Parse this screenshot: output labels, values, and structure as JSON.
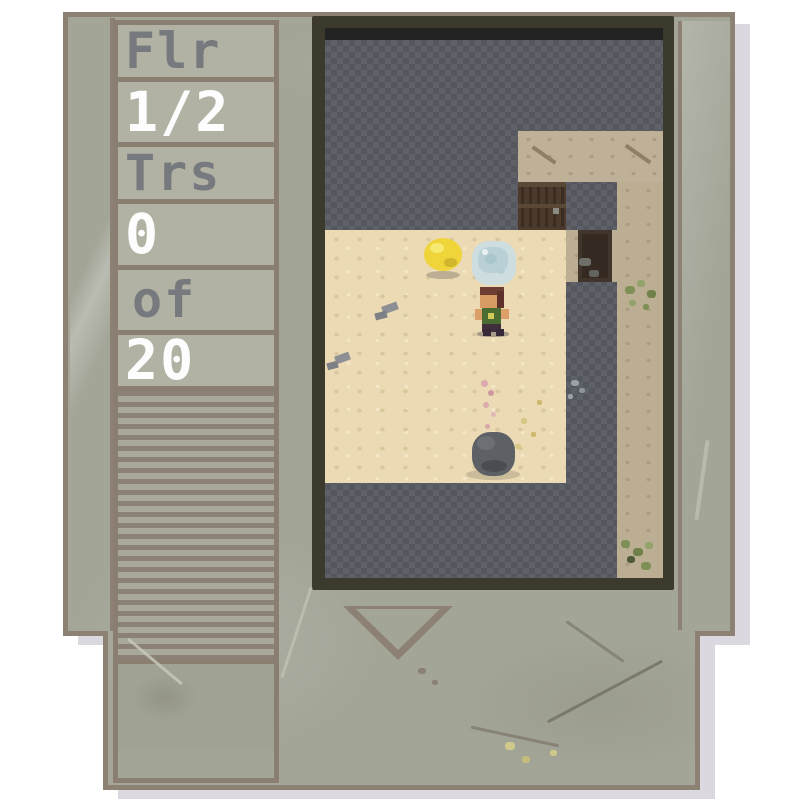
{
  "hud": {
    "cells": [
      {
        "id": "floor-label",
        "label": "Flr",
        "variant": "dim",
        "height": 57
      },
      {
        "id": "floor-value",
        "label": "1/2",
        "variant": "bright",
        "height": 65
      },
      {
        "id": "treasure-label",
        "label": "Trs",
        "variant": "dim",
        "height": 57
      },
      {
        "id": "treasure-count",
        "label": "0",
        "variant": "bright",
        "height": 66
      },
      {
        "id": "treasure-of",
        "label": "of",
        "variant": "dim",
        "height": 65,
        "pad": 14
      },
      {
        "id": "treasure-total",
        "label": "20",
        "variant": "bright",
        "height": 56
      }
    ],
    "text_dim_color": "#76797d",
    "text_bright_color": "#fdfdfd"
  },
  "cartridge": {
    "body_color": "#a3a597",
    "border_color": "#8c8173",
    "cell_color": "#b1b2a3",
    "grip_line_color": "#8b8177",
    "shadow_color": "#dbd9df",
    "window_frame_color": "#3c3a2c"
  },
  "viewport": {
    "wall_color": "#575b61",
    "sand_color": "#ebdab4",
    "rock_floor_color": "#bfb197",
    "layers": [
      {
        "name": "void-strip",
        "rects": [
          {
            "x": 0,
            "y": 0,
            "w": 338,
            "h": 12,
            "c": "#232323"
          }
        ]
      },
      {
        "name": "rock-floor-regions",
        "rects": [
          {
            "x": 193,
            "y": 103,
            "w": 145,
            "h": 51,
            "c": "#bfb197",
            "cls": "tex-tan"
          },
          {
            "x": 292,
            "y": 154,
            "w": 46,
            "h": 396,
            "c": "#bcae93",
            "cls": "tex-tan"
          },
          {
            "x": 241,
            "y": 202,
            "w": 51,
            "h": 52,
            "c": "#bcae93",
            "cls": "tex-tan"
          }
        ]
      },
      {
        "name": "sand-floor-region",
        "rects": [
          {
            "x": 0,
            "y": 202,
            "w": 241,
            "h": 253,
            "c": "#ebdab4",
            "cls": "tex-sand"
          }
        ]
      },
      {
        "name": "door-sprite",
        "rects": [
          {
            "x": 193,
            "y": 154,
            "w": 48,
            "h": 48,
            "c": "#4c3b2d"
          },
          {
            "x": 196,
            "y": 157,
            "w": 3,
            "h": 42,
            "c": "#3b2d22"
          },
          {
            "x": 204,
            "y": 157,
            "w": 3,
            "h": 42,
            "c": "#3b2d22"
          },
          {
            "x": 212,
            "y": 157,
            "w": 3,
            "h": 42,
            "c": "#3b2d22"
          },
          {
            "x": 220,
            "y": 157,
            "w": 3,
            "h": 42,
            "c": "#3b2d22"
          },
          {
            "x": 228,
            "y": 157,
            "w": 3,
            "h": 42,
            "c": "#3b2d22"
          },
          {
            "x": 236,
            "y": 157,
            "w": 3,
            "h": 42,
            "c": "#3b2d22"
          },
          {
            "x": 193,
            "y": 154,
            "w": 48,
            "h": 5,
            "c": "#5a4736"
          },
          {
            "x": 193,
            "y": 176,
            "w": 48,
            "h": 4,
            "c": "#5a4736"
          },
          {
            "x": 228,
            "y": 180,
            "w": 6,
            "h": 6,
            "c": "#8b8b81"
          }
        ]
      },
      {
        "name": "dark-shaft",
        "rects": [
          {
            "x": 253,
            "y": 202,
            "w": 34,
            "h": 52,
            "c": "#41342a"
          },
          {
            "x": 257,
            "y": 206,
            "w": 26,
            "h": 44,
            "c": "#352a22"
          },
          {
            "x": 254,
            "y": 230,
            "w": 12,
            "h": 8,
            "c": "#6f6f69",
            "r": 30
          },
          {
            "x": 264,
            "y": 242,
            "w": 10,
            "h": 7,
            "c": "#63635e",
            "r": 30
          }
        ]
      },
      {
        "name": "floor-marks",
        "rects": [
          {
            "x": 205,
            "y": 125,
            "w": 28,
            "h": 4,
            "c": "#8f7f66",
            "rot": 35
          },
          {
            "x": 298,
            "y": 124,
            "w": 30,
            "h": 4,
            "c": "#8f7f66",
            "rot": 35
          },
          {
            "x": 57,
            "y": 276,
            "w": 16,
            "h": 8,
            "c": "#8d8f94",
            "rot": -20
          },
          {
            "x": 50,
            "y": 284,
            "w": 12,
            "h": 7,
            "c": "#7d8085",
            "rot": -15
          },
          {
            "x": 10,
            "y": 326,
            "w": 15,
            "h": 8,
            "c": "#8d8f94",
            "rot": -20
          },
          {
            "x": 2,
            "y": 334,
            "w": 11,
            "h": 7,
            "c": "#7d8085",
            "rot": -15
          },
          {
            "x": 156,
            "y": 352,
            "w": 7,
            "h": 7,
            "c": "#dba9ae",
            "r": 50
          },
          {
            "x": 163,
            "y": 362,
            "w": 6,
            "h": 6,
            "c": "#cf98a0",
            "r": 50
          },
          {
            "x": 158,
            "y": 374,
            "w": 6,
            "h": 6,
            "c": "#dba9ae",
            "r": 50
          },
          {
            "x": 166,
            "y": 384,
            "w": 5,
            "h": 5,
            "c": "#e0b6ba",
            "r": 50
          },
          {
            "x": 160,
            "y": 396,
            "w": 5,
            "h": 5,
            "c": "#d8a8ac",
            "r": 50
          },
          {
            "x": 196,
            "y": 390,
            "w": 6,
            "h": 6,
            "c": "#d9c784",
            "r": 40
          },
          {
            "x": 206,
            "y": 404,
            "w": 5,
            "h": 5,
            "c": "#cdb86f",
            "r": 40
          },
          {
            "x": 190,
            "y": 416,
            "w": 6,
            "h": 5,
            "c": "#d9c784",
            "r": 40
          },
          {
            "x": 212,
            "y": 372,
            "w": 5,
            "h": 5,
            "c": "#cdb86f",
            "r": 40
          },
          {
            "x": 300,
            "y": 258,
            "w": 10,
            "h": 8,
            "c": "#7e9055",
            "r": 40
          },
          {
            "x": 312,
            "y": 252,
            "w": 8,
            "h": 7,
            "c": "#93a36b",
            "r": 40
          },
          {
            "x": 322,
            "y": 262,
            "w": 9,
            "h": 8,
            "c": "#6f8049",
            "r": 40
          },
          {
            "x": 304,
            "y": 272,
            "w": 7,
            "h": 6,
            "c": "#93a36b",
            "r": 40
          },
          {
            "x": 318,
            "y": 276,
            "w": 6,
            "h": 6,
            "c": "#7e9055",
            "r": 40
          },
          {
            "x": 296,
            "y": 512,
            "w": 9,
            "h": 8,
            "c": "#7e9055",
            "r": 40
          },
          {
            "x": 308,
            "y": 520,
            "w": 10,
            "h": 8,
            "c": "#6f8049",
            "r": 40
          },
          {
            "x": 320,
            "y": 514,
            "w": 8,
            "h": 7,
            "c": "#93a36b",
            "r": 40
          },
          {
            "x": 302,
            "y": 528,
            "w": 8,
            "h": 7,
            "c": "#4e5a3a",
            "r": 40
          },
          {
            "x": 316,
            "y": 534,
            "w": 10,
            "h": 8,
            "c": "#7e9055",
            "r": 40
          },
          {
            "x": 246,
            "y": 352,
            "w": 8,
            "h": 6,
            "c": "#9aa1a8",
            "r": 40
          },
          {
            "x": 254,
            "y": 360,
            "w": 6,
            "h": 5,
            "c": "#8d949b",
            "r": 40
          },
          {
            "x": 243,
            "y": 366,
            "w": 5,
            "h": 5,
            "c": "#9aa1a8",
            "r": 40
          }
        ]
      },
      {
        "name": "coin-sprite",
        "rects": [
          {
            "x": 101,
            "y": 243,
            "w": 34,
            "h": 8,
            "c": "#bcae92",
            "r": 50
          },
          {
            "x": 99,
            "y": 210,
            "w": 38,
            "h": 33,
            "c": "#efd53a",
            "r": 50
          },
          {
            "x": 105,
            "y": 215,
            "w": 14,
            "h": 10,
            "c": "#f6ea71",
            "r": 50
          },
          {
            "x": 119,
            "y": 230,
            "w": 13,
            "h": 9,
            "c": "#d2b72c",
            "r": 45
          }
        ]
      },
      {
        "name": "gem-sprite",
        "rects": [
          {
            "x": 147,
            "y": 213,
            "w": 44,
            "h": 44,
            "c": "#cddde0",
            "r": 38
          },
          {
            "x": 153,
            "y": 219,
            "w": 30,
            "h": 26,
            "c": "#b9d1d6",
            "r": 40
          },
          {
            "x": 160,
            "y": 226,
            "w": 12,
            "h": 10,
            "c": "#a9c6cd",
            "r": 50
          },
          {
            "x": 172,
            "y": 238,
            "w": 8,
            "h": 8,
            "c": "#b6cfd5",
            "r": 50
          },
          {
            "x": 157,
            "y": 221,
            "w": 6,
            "h": 6,
            "c": "#e8f2f2",
            "r": 50
          }
        ]
      },
      {
        "name": "player-sprite",
        "rects": [
          {
            "x": 152,
            "y": 303,
            "w": 32,
            "h": 6,
            "c": "#a69c89",
            "r": 40
          },
          {
            "x": 157,
            "y": 295,
            "w": 19,
            "h": 9,
            "c": "#3f2e3c"
          },
          {
            "x": 158,
            "y": 301,
            "w": 8,
            "h": 7,
            "c": "#352837"
          },
          {
            "x": 171,
            "y": 301,
            "w": 8,
            "h": 7,
            "c": "#352837"
          },
          {
            "x": 157,
            "y": 274,
            "w": 19,
            "h": 22,
            "c": "#4b6c31"
          },
          {
            "x": 150,
            "y": 281,
            "w": 7,
            "h": 11,
            "c": "#dd9f6a"
          },
          {
            "x": 176,
            "y": 281,
            "w": 8,
            "h": 10,
            "c": "#dd9f6a"
          },
          {
            "x": 163,
            "y": 285,
            "w": 6,
            "h": 6,
            "c": "#d2c757"
          },
          {
            "x": 155,
            "y": 267,
            "w": 17,
            "h": 13,
            "c": "#d79a63"
          },
          {
            "x": 155,
            "y": 259,
            "w": 24,
            "h": 8,
            "c": "#6d3c33"
          },
          {
            "x": 172,
            "y": 263,
            "w": 7,
            "h": 17,
            "c": "#5d3029"
          }
        ]
      },
      {
        "name": "boulder-sprite",
        "rects": [
          {
            "x": 141,
            "y": 441,
            "w": 54,
            "h": 11,
            "c": "#cabb9a",
            "r": 50
          },
          {
            "x": 147,
            "y": 404,
            "w": 43,
            "h": 44,
            "c": "#5d6165",
            "r": 42
          },
          {
            "x": 152,
            "y": 408,
            "w": 18,
            "h": 14,
            "c": "#6c7075",
            "r": 50
          },
          {
            "x": 156,
            "y": 432,
            "w": 26,
            "h": 12,
            "c": "#4a4e53",
            "r": 50
          }
        ]
      }
    ]
  }
}
